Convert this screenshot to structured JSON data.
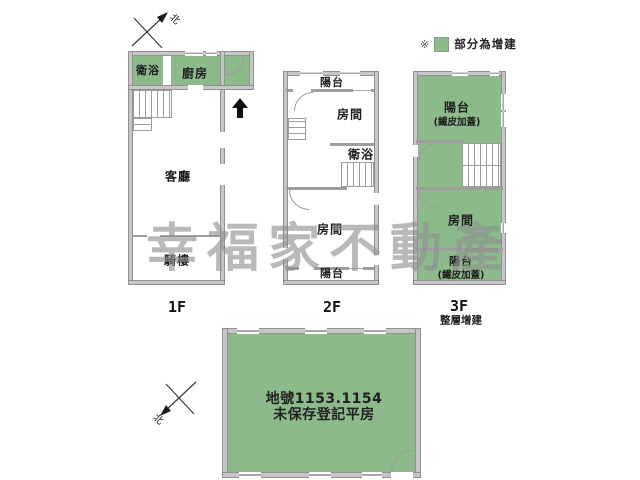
{
  "legend": {
    "marker": "※",
    "label": "部分為增建"
  },
  "watermark": "幸福家不動產",
  "compass_north": "北",
  "icons": {
    "compass": "north-compass-icon",
    "entrance": "entrance-arrow-icon"
  },
  "f1": {
    "label": "1F",
    "bath": "衛浴",
    "kitchen": "廚房",
    "living": "客廳",
    "arcade": "騎樓"
  },
  "f2": {
    "label": "2F",
    "balcony_top": "陽台",
    "room_top": "房間",
    "bath": "衛浴",
    "room_bottom": "房間",
    "balcony_bottom": "陽台"
  },
  "f3": {
    "label": "3F",
    "note": "整層增建",
    "balcony_top": "陽台",
    "balcony_top_note": "(鐵皮加蓋)",
    "room": "房間",
    "balcony_bottom": "陽台",
    "balcony_bottom_note": "(鐵皮加蓋)"
  },
  "ground": {
    "line1": "地號1153.1154",
    "line2": "未保存登記平房"
  },
  "colors": {
    "addition_green": "#8cba8a",
    "wall_gray": "#c6c6c6",
    "watermark_gray": "#8f8f8f"
  }
}
